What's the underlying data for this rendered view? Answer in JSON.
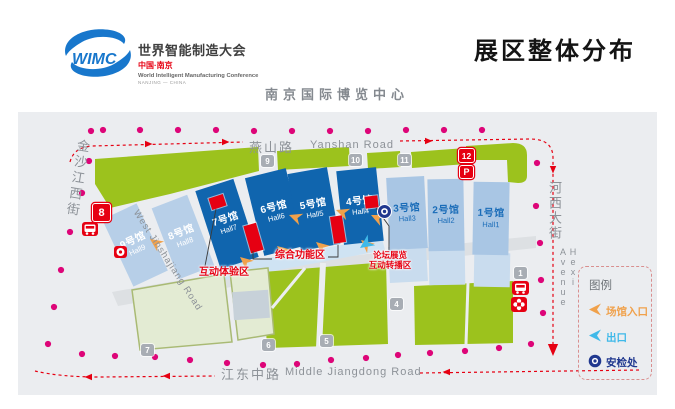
{
  "header": {
    "logo": {
      "acronym": "WIMC",
      "title_cn": "世界智能制造大会",
      "region_cn": "中国·南京",
      "title_en": "World Intelligent Manufacturing Conference",
      "region_en": "NANJING — CHINA"
    },
    "page_title": "展区整体分布",
    "venue": "南京国际博览中心"
  },
  "roads": {
    "north_cn": "燕山路",
    "north_en": "Yanshan Road",
    "south_cn": "江东中路",
    "south_en": "Middle Jiangdong Road",
    "west_cn": "金沙江西街",
    "west_en": "West Jinshajiang Road",
    "east_cn": "河西大街",
    "east_en": "Hexi Avenue"
  },
  "halls": [
    {
      "cn": "9号馆",
      "en": "Hall9"
    },
    {
      "cn": "8号馆",
      "en": "Hall8"
    },
    {
      "cn": "7号馆",
      "en": "Hall7"
    },
    {
      "cn": "6号馆",
      "en": "Hall6"
    },
    {
      "cn": "5号馆",
      "en": "Hall5"
    },
    {
      "cn": "4号馆",
      "en": "Hall4"
    },
    {
      "cn": "3号馆",
      "en": "Hall3"
    },
    {
      "cn": "2号馆",
      "en": "Hall2"
    },
    {
      "cn": "1号馆",
      "en": "Hall1"
    }
  ],
  "zones": {
    "interactive": "互动体验区",
    "function": "综合功能区",
    "forum_line1": "论坛展览",
    "forum_line2": "互动转播区"
  },
  "markers": {
    "metro_line": "8",
    "gate_12": "12",
    "parking": "P"
  },
  "gate_tags": [
    "9",
    "10",
    "11",
    "7",
    "6",
    "5",
    "4",
    "1"
  ],
  "legend": {
    "title": "图例",
    "entrance": "场馆入口",
    "exit": "出口",
    "security": "安检处"
  },
  "colors": {
    "accent_red": "#e60012",
    "hall_dark_blue": "#1065ae",
    "hall_light_blue": "#b7cfe8",
    "hall_mid_blue": "#a9c6e4",
    "lawn_green": "#9cc21d",
    "entrance_orange": "#f0a14b",
    "exit_cyan": "#3fb9e9",
    "security_navy": "#20388f",
    "route_pink": "#dd0578"
  }
}
